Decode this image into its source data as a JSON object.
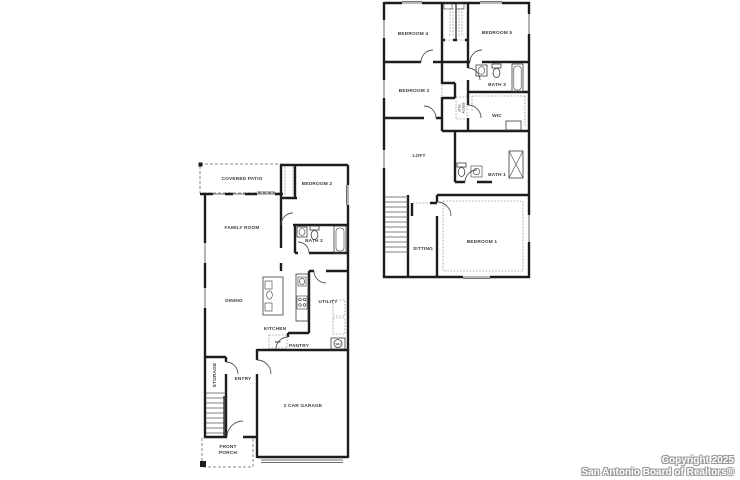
{
  "image": {
    "width": 740,
    "height": 480,
    "background": "#ffffff"
  },
  "watermark": {
    "line1": "Copyright 2025",
    "line2": "San Antonio Board of Realtors®",
    "text_color": "#ffffff",
    "outline_color": "#9a9a9a"
  },
  "first_floor": {
    "labels": {
      "covered_patio": "COVERED PATIO",
      "bedroom2": "BEDROOM 2",
      "family_room": "FAMILY ROOM",
      "bath2": "BATH 2",
      "dining": "DINING",
      "kitchen": "KITCHEN",
      "utility": "UTILITY",
      "pantry": "PANTRY",
      "ref": "REF",
      "wh": "WH",
      "storage": "STORAGE",
      "entry": "ENTRY",
      "garage": "2 CAR GARAGE",
      "porch_line1": "FRONT",
      "porch_line2": "PORCH"
    }
  },
  "second_floor": {
    "labels": {
      "bedroom4": "BEDROOM 4",
      "bedroom5": "BEDROOM 5",
      "bedroom3": "BEDROOM 3",
      "bath3": "BATH 3",
      "wic": "WIC",
      "attic_line1": "ATTIC",
      "attic_line2": "ACCESS",
      "loft": "LOFT",
      "bath1": "BATH 1",
      "sitting": "SITTING",
      "bedroom1": "BEDROOM 1"
    }
  },
  "colors": {
    "wall": "#1c1c1c",
    "label": "#3d3d3d",
    "dashed": "#666666"
  }
}
